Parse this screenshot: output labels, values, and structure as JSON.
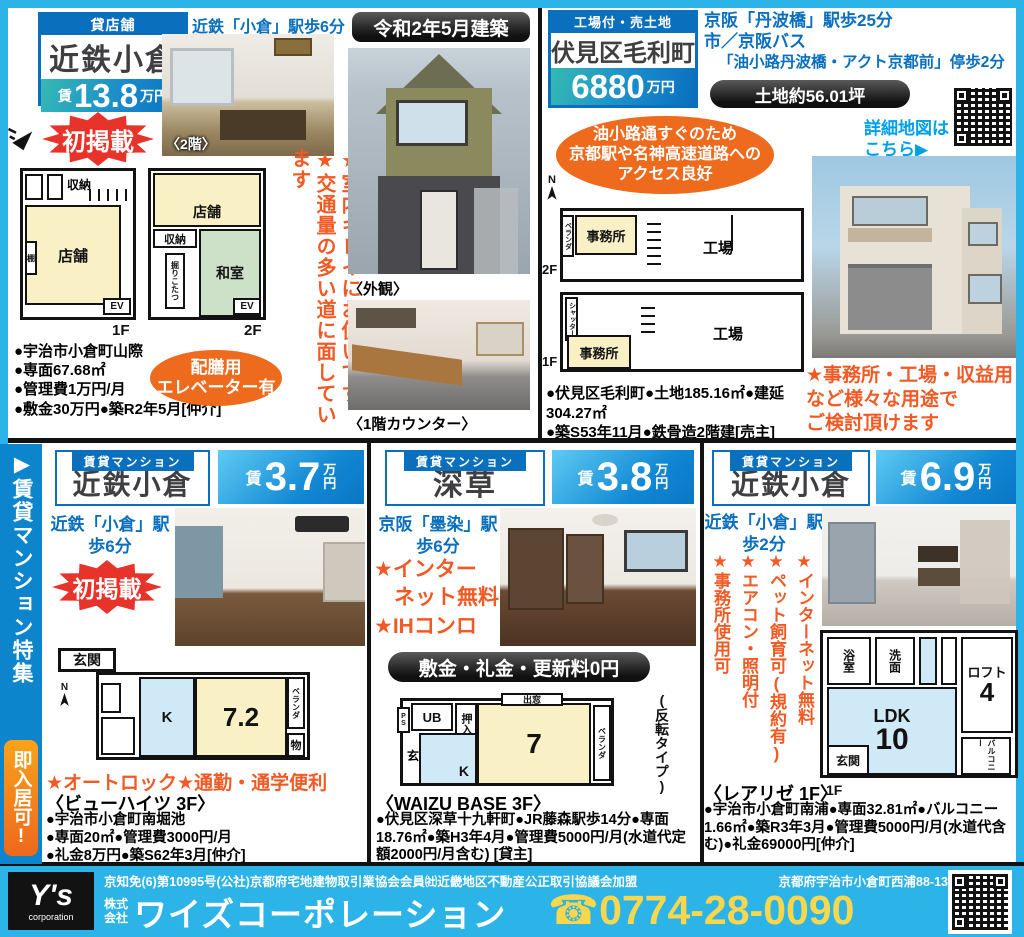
{
  "colors": {
    "frame": "#2cb3e8",
    "deep_blue": "#0a6fbd",
    "orange": "#f15a24",
    "red": "#e8332a",
    "yellow": "#f8d64e"
  },
  "shop": {
    "category": "貸店舗",
    "name": "近鉄小倉",
    "rent": "賃",
    "price": "13.8",
    "unit": "万円",
    "station": "近鉄「小倉」駅歩6分",
    "new_badge": "初掲載",
    "photo_caption": "〈2階〉",
    "plan1f": {
      "storage": "収納",
      "shop": "店舗",
      "shelf": "棚",
      "ev": "EV",
      "floor": "1F"
    },
    "plan2f": {
      "shop": "店舗",
      "storage": "収納",
      "washitsu": "和室",
      "kotatsu": "掘りこたつ",
      "ev": "EV",
      "floor": "2F"
    },
    "details": [
      "●宇治市小倉町山際",
      "●専面67.68㎡",
      "●管理費1万円/月",
      "●敷金30万円●築R2年5月[仲介]"
    ],
    "oval_line1": "配膳用",
    "oval_line2": "エレベーター有",
    "note1": "★室内キレイにお使いです",
    "note2": "★交通量の多い道に面しています"
  },
  "center": {
    "built": "令和2年5月建築",
    "caption_exterior": "〈外観〉",
    "caption_counter": "〈1階カウンター〉"
  },
  "land": {
    "category": "工場付・売土地",
    "name": "伏見区毛利町",
    "price": "6880",
    "unit": "万円",
    "access1": "京阪「丹波橋」駅歩25分",
    "access2": "市／京阪バス",
    "access3": "「油小路丹波橋・アクト京都前」停歩2分",
    "area_pill": "土地約56.01坪",
    "map_line1": "詳細地図は",
    "map_line2": "こちら▶",
    "oval_line1": "油小路通すぐのため",
    "oval_line2": "京都駅や名神高速道路への",
    "oval_line3": "アクセス良好",
    "compass": "N",
    "plan2f": {
      "veranda": "ベランダ",
      "office": "事務所",
      "factory": "工場",
      "floor": "2F"
    },
    "plan1f": {
      "shutter": "シャッター",
      "office": "事務所",
      "factory": "工場",
      "floor": "1F"
    },
    "details1": "●伏見区毛利町●土地185.16㎡●建延304.27㎡",
    "details2": "●築S53年11月●鉄骨造2階建[売主]",
    "note1": "★事務所・工場・収益用",
    "note2": "など様々な用途で",
    "note3": "ご検討頂けます"
  },
  "sidebar": {
    "title": "▶賃貸マンション特集",
    "badge": "即入居可!"
  },
  "apartments": [
    {
      "category": "賃貸マンション",
      "name": "近鉄小倉",
      "rent": "賃",
      "price": "3.7",
      "unit_top": "万",
      "unit_bottom": "円",
      "station1": "近鉄「小倉」駅",
      "station2": "歩6分",
      "new_badge": "初掲載",
      "plan": {
        "genkan": "玄関",
        "compass": "N",
        "k": "K",
        "room": "7.2",
        "veranda": "ベランダ",
        "storage": "物"
      },
      "features": "★オートロック★通勤・通学便利",
      "building": "〈ビューハイツ 3F〉",
      "details": [
        "●宇治市小倉町南堀池",
        "●専面20㎡●管理費3000円/月",
        "●礼金8万円●築S62年3月[仲介]"
      ]
    },
    {
      "category": "賃貸マンション",
      "name": "深草",
      "rent": "賃",
      "price": "3.8",
      "unit_top": "万",
      "unit_bottom": "円",
      "station1": "京阪「墨染」駅",
      "station2": "歩6分",
      "feature1": "★インター",
      "feature2": "ネット無料",
      "feature3": "★IHコンロ",
      "zero_pill": "敷金・礼金・更新料0円",
      "plan": {
        "ps": "PS",
        "ub": "UB",
        "oshiire": "押入",
        "demado": "出窓",
        "room": "7",
        "veranda": "ベランダ",
        "gen": "玄",
        "k": "K"
      },
      "type_note": "(反転タイプ)",
      "building": "〈WAIZU BASE 3F〉",
      "details": "●伏見区深草十九軒町●JR藤森駅歩14分●専面18.76㎡●築H3年4月●管理費5000円/月(水道代定額2000円/月含む) [貸主]"
    },
    {
      "category": "賃貸マンション",
      "name": "近鉄小倉",
      "rent": "賃",
      "price": "6.9",
      "unit_top": "万",
      "unit_bottom": "円",
      "station1": "近鉄「小倉」駅",
      "station2": "歩2分",
      "features": [
        "★インターネット無料",
        "★ペット飼育可(規約有)",
        "★エアコン・照明付",
        "★事務所使用可"
      ],
      "plan": {
        "bath": "浴室",
        "washstand": "洗面",
        "loft": "ロフト",
        "loft_size": "4",
        "ldk": "LDK",
        "ldk_size": "10",
        "genkan": "玄関",
        "balcony": "バルコニー",
        "floor": "1F"
      },
      "building": "〈レアリゼ 1F〉",
      "details": "●宇治市小倉町南浦●専面32.81㎡●バルコニー1.66㎡●築R3年3月●管理費5000円/月(水道代含む)●礼金69000円[仲介]"
    }
  ],
  "footer": {
    "logo_main": "Y's",
    "logo_sub": "corporation",
    "license": "京知免(6)第10995号(公社)京都府宅地建物取引業協会会員㈳近畿地区不動産公正取引協議会加盟",
    "address": "京都府宇治市小倉町西浦88-13",
    "company_prefix_top": "株式",
    "company_prefix_bottom": "会社",
    "company": "ワイズコーポレーション",
    "phone": "☎0774-28-0090"
  }
}
